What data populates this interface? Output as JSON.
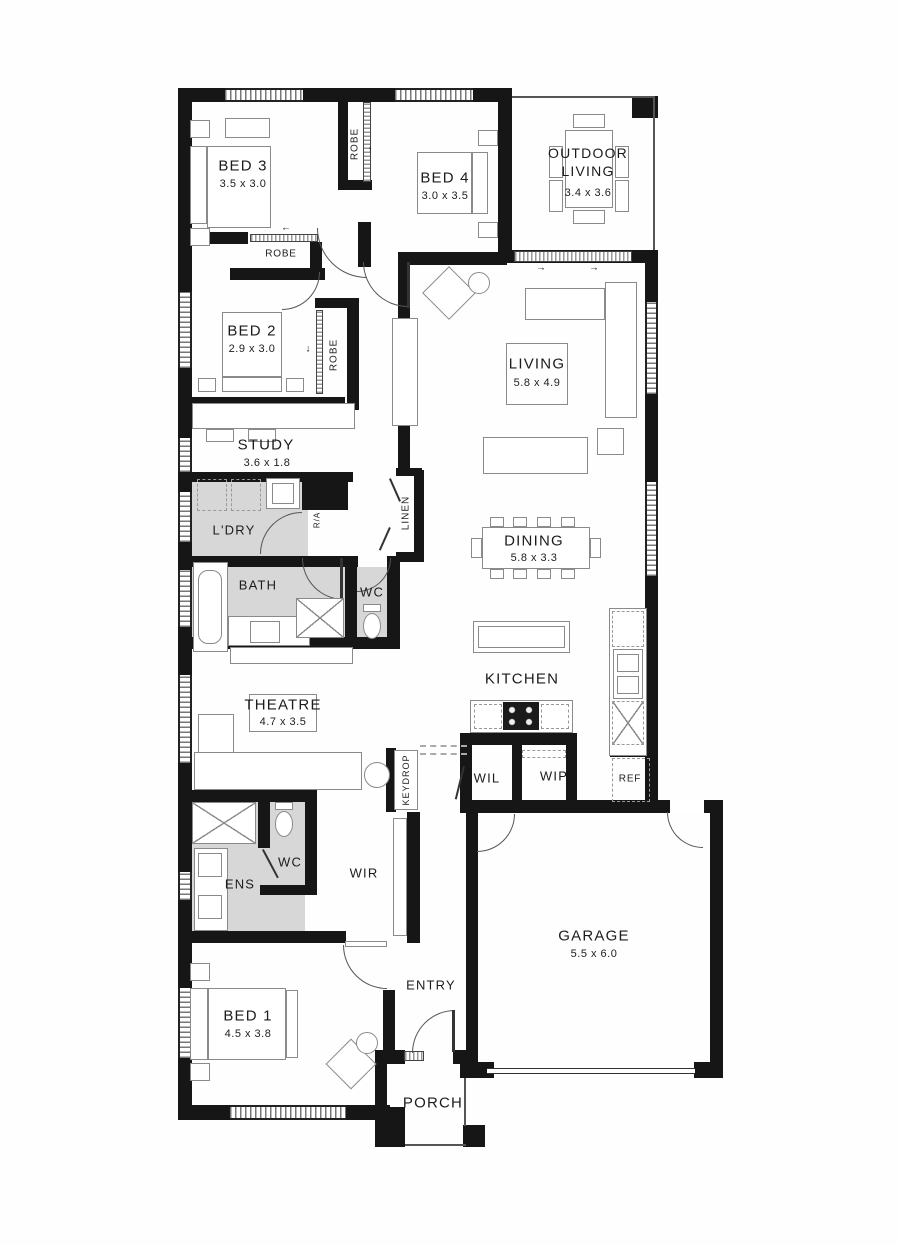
{
  "plan": {
    "type": "floor-plan",
    "colors": {
      "wall": "#161616",
      "wet_area": "#d7d7d7",
      "furniture": "#8a8a8a",
      "label": "#1c1c1c",
      "background": "#ffffff"
    },
    "rooms": {
      "bed3": {
        "label": "BED 3",
        "dims": "3.5 x 3.0"
      },
      "bed4": {
        "label": "BED 4",
        "dims": "3.0 x 3.5"
      },
      "outdoor": {
        "label": "OUTDOOR LIVING",
        "dims": "3.4 x 3.6"
      },
      "bed2": {
        "label": "BED 2",
        "dims": "2.9 x 3.0"
      },
      "living": {
        "label": "LIVING",
        "dims": "5.8 x 4.9"
      },
      "study": {
        "label": "STUDY",
        "dims": "3.6 x 1.8"
      },
      "ldry": {
        "label": "L'DRY"
      },
      "bath": {
        "label": "BATH"
      },
      "wc_main": {
        "label": "WC"
      },
      "dining": {
        "label": "DINING",
        "dims": "5.8 x 3.3"
      },
      "kitchen": {
        "label": "KITCHEN"
      },
      "theatre": {
        "label": "THEATRE",
        "dims": "4.7 x 3.5"
      },
      "wil": {
        "label": "WIL"
      },
      "wip": {
        "label": "WIP"
      },
      "ref": {
        "label": "REF"
      },
      "keydrop": {
        "label": "KEYDROP"
      },
      "wc_ens": {
        "label": "WC"
      },
      "ens": {
        "label": "ENS"
      },
      "wir": {
        "label": "WIR"
      },
      "garage": {
        "label": "GARAGE",
        "dims": "5.5 x 6.0"
      },
      "bed1": {
        "label": "BED 1",
        "dims": "4.5 x 3.8"
      },
      "entry": {
        "label": "ENTRY"
      },
      "porch": {
        "label": "PORCH"
      },
      "robe_bed3": {
        "label": "ROBE"
      },
      "robe_hall": {
        "label": "ROBE"
      },
      "robe_bed2": {
        "label": "ROBE"
      },
      "linen": {
        "label": "LINEN"
      },
      "return_air": {
        "label": "R/A"
      }
    },
    "arrows": {
      "up": "↑",
      "down": "↓",
      "left": "←",
      "right": "→"
    }
  }
}
